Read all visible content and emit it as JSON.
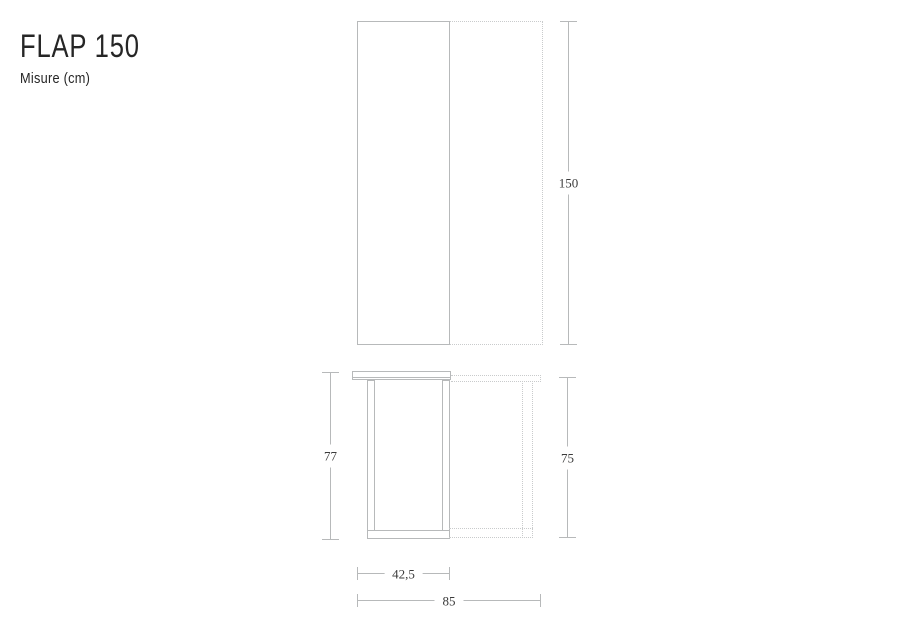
{
  "header": {
    "title": "FLAP 150",
    "subtitle": "Misure (cm)"
  },
  "dims": {
    "front_height": "150",
    "side_height_closed": "77",
    "side_height_open": "75",
    "side_width_closed": "42,5",
    "side_width_open": "85"
  },
  "colors": {
    "line": "#b7b9ba",
    "dotted_line": "#c9cbcc",
    "dimension_text": "#3b3b3b",
    "title_text": "#262626"
  }
}
